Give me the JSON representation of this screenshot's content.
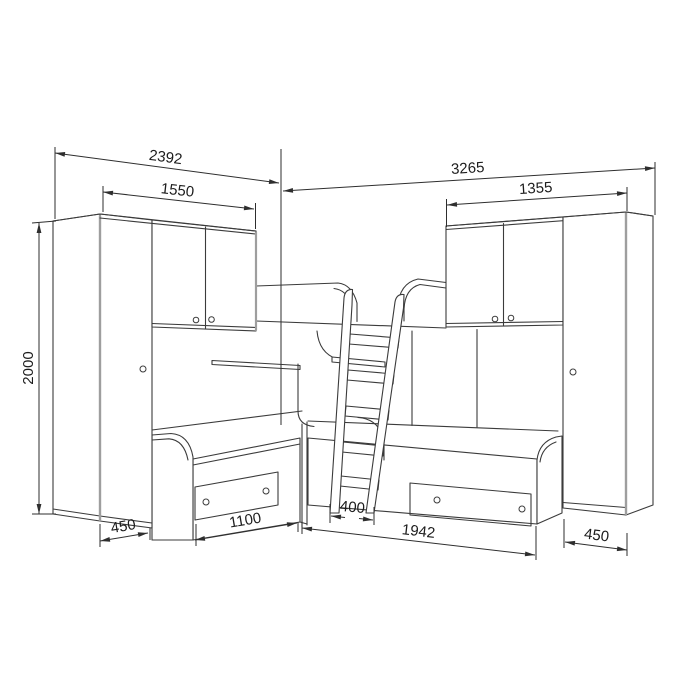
{
  "drawing": {
    "kind": "furniture-dimension-diagram",
    "subject": "corner bunk-bed set: two wardrobes, two wall cabinets, two lower beds with drawers, central ladder to upper bunk",
    "units": "mm"
  },
  "dimensions": {
    "overall_width_left": "2392",
    "cabinet_span_left": "1550",
    "overall_width_right": "3265",
    "cabinet_span_right": "1355",
    "overall_height": "2000",
    "wardrobe_depth_left": "450",
    "bed_front_left": "1100",
    "ladder_width": "400",
    "bed_front_right": "1942",
    "wardrobe_depth_right": "450"
  },
  "colors": {
    "background": "#ffffff",
    "line": "#3b3b3b",
    "dimension_line": "#2e2e2e",
    "panel_edge_highlight": "#9e9e9e",
    "text": "#1c1c1c"
  }
}
